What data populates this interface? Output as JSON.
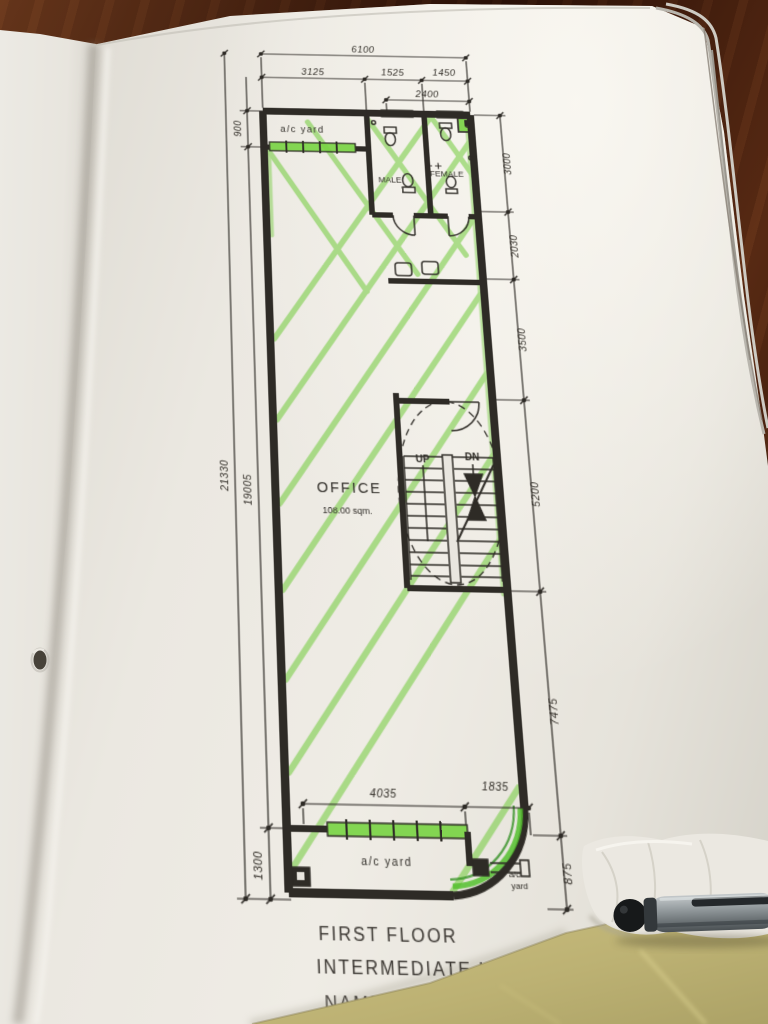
{
  "plan": {
    "title": {
      "line1": "FIRST FLOOR",
      "line2": "INTERMEDIATE UNIT",
      "line3_partial": "NAME"
    },
    "rooms": {
      "ac_yard_top": "a/c yard",
      "male": "MALE",
      "female": "FEMALE",
      "office": "OFFICE",
      "office_area": "108.00 sqm.",
      "ac_yard_bottom": "a/c yard",
      "ac_yard_corner_line1": "a/c",
      "ac_yard_corner_line2": "yard",
      "up": "UP",
      "dn": "DN"
    },
    "dims": {
      "top_overall": "6100",
      "top_1": "3125",
      "top_2": "1525",
      "top_3": "1450",
      "top_inner": "2400",
      "left_overall": "21330",
      "left_main": "19005",
      "left_top": "900",
      "left_bottom": "1300",
      "right_1": "3000",
      "right_2": "2030",
      "right_3": "3500",
      "right_4": "5200",
      "right_5": "7475",
      "right_6": "875",
      "bottom_1": "4035",
      "bottom_2": "1835"
    },
    "colors": {
      "ink": "#2e2b26",
      "highlighter": "#6fca38",
      "paper": "#e9e6df",
      "wood_table": "#45200f",
      "yellow_paper": "#c0b577",
      "pen_gray": "#878e92"
    }
  }
}
